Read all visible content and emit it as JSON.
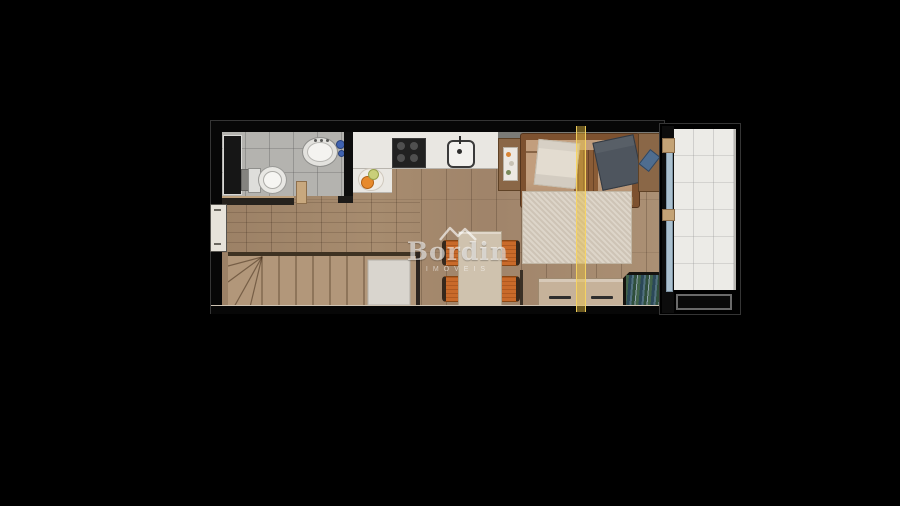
{
  "watermark": {
    "brand": "Bordin",
    "tagline": "IMÓVEIS",
    "logo_icon": "mountains-icon",
    "color": "#ffffff"
  },
  "palette": {
    "background": "#000000",
    "wood_floor": "#a78c6f",
    "stairs_wood": "#b2977a",
    "bathroom_tile": "#b4b3af",
    "counter_white": "#e9e7e2",
    "balcony_tile": "#ecebe7",
    "sofa_cushion": "#c29e7d",
    "sofa_wood_frame": "#7d512f",
    "rug": "#d6ccbd",
    "chair_orange": "#c96a2a",
    "dining_table": "#cfc2ae",
    "section_line": "#e9bf42",
    "glass_door": "#aac0cf",
    "plant_green": "#2e8f3c"
  },
  "floorplan": {
    "rooms": [
      "bathroom",
      "kitchen",
      "living-room",
      "dining-area",
      "stairs",
      "balcony"
    ],
    "furniture": [
      "toilet",
      "bathroom-sink",
      "cooktop",
      "kitchen-sink",
      "fruit-bowl",
      "sofa",
      "throw-blanket-light",
      "throw-blanket-dark",
      "side-table-left",
      "side-table-right",
      "rug",
      "dining-table",
      "dining-chairs",
      "table-plant",
      "tv-sideboard",
      "planter-box",
      "sliding-glass-door",
      "window",
      "stair-landing",
      "balcony-planter"
    ]
  }
}
